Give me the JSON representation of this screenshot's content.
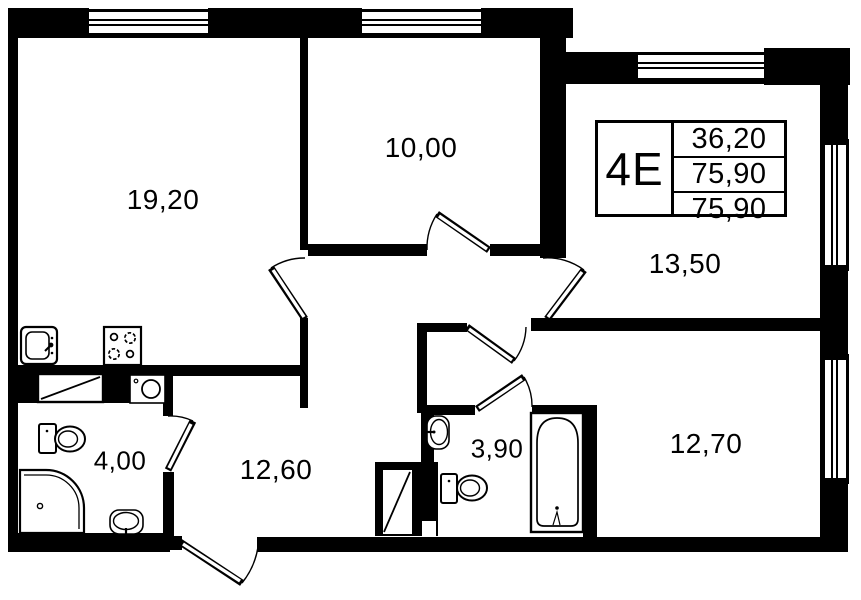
{
  "floor_plan": {
    "unit": {
      "type_label": "4E",
      "area_rows": [
        "36,20",
        "75,90",
        "75,90"
      ]
    },
    "rooms": [
      {
        "id": "living-kitchen",
        "area": "19,20"
      },
      {
        "id": "bedroom-top",
        "area": "10,00"
      },
      {
        "id": "room-right-upper",
        "area": "13,50"
      },
      {
        "id": "room-right-lower",
        "area": "12,70"
      },
      {
        "id": "hallway",
        "area": "12,60"
      },
      {
        "id": "bathroom-left",
        "area": "4,00"
      },
      {
        "id": "bathroom-middle",
        "area": "3,90"
      }
    ],
    "fixtures": [
      "kitchen-sink",
      "stove-4-burner",
      "wardrobe-closet",
      "washing-machine",
      "toilet-left",
      "corner-shower",
      "washbasin-left",
      "duct-shaft",
      "washbasin-middle",
      "toilet-middle",
      "bathtub"
    ],
    "window_count": 5,
    "door_count": 7,
    "colors": {
      "wall": "#000000",
      "background": "#ffffff"
    }
  }
}
